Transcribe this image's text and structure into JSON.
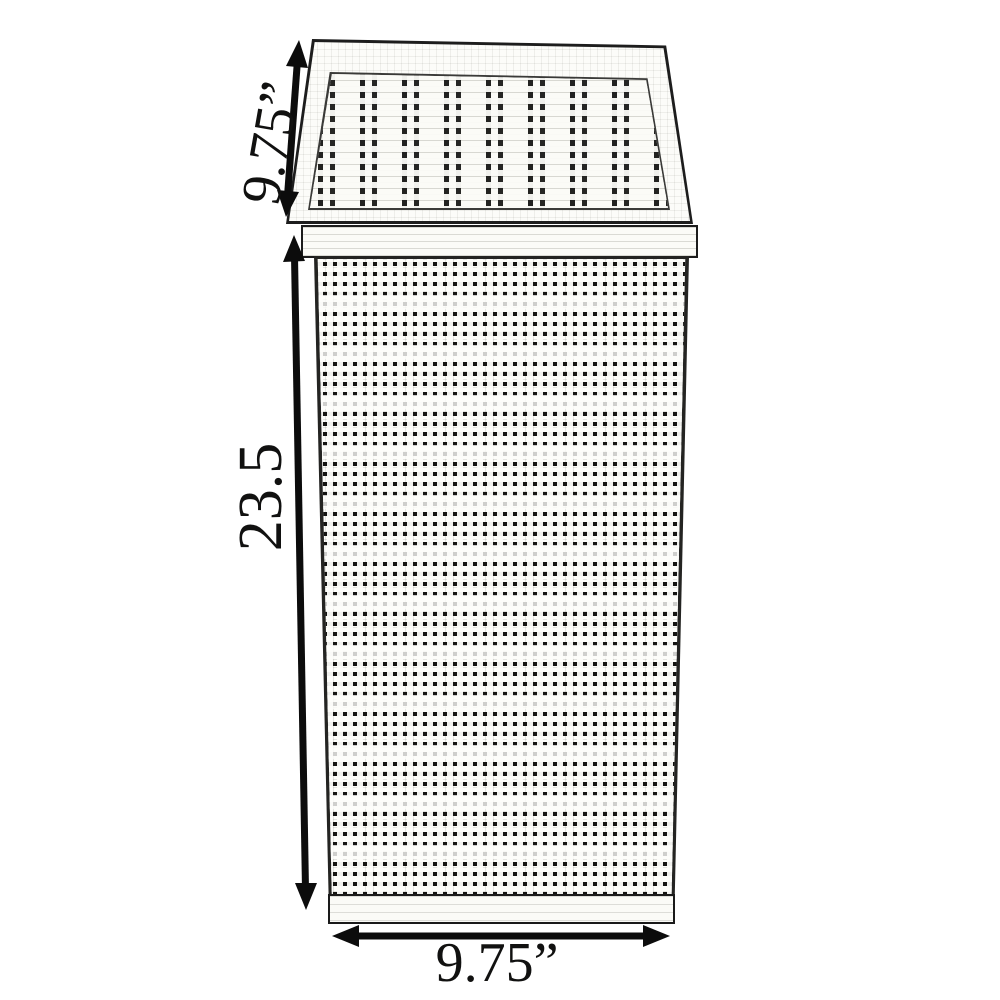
{
  "labels": {
    "top_depth": "9.75”",
    "height": "23.5",
    "bottom_width": "9.75”"
  },
  "colors": {
    "ink": "#0c0c0c",
    "background": "#ffffff"
  },
  "icons": {
    "top_depth_arrow": "double-headed-arrow-diagonal",
    "height_arrow": "double-headed-arrow-vertical",
    "bottom_width_arrow": "double-headed-arrow-horizontal"
  }
}
